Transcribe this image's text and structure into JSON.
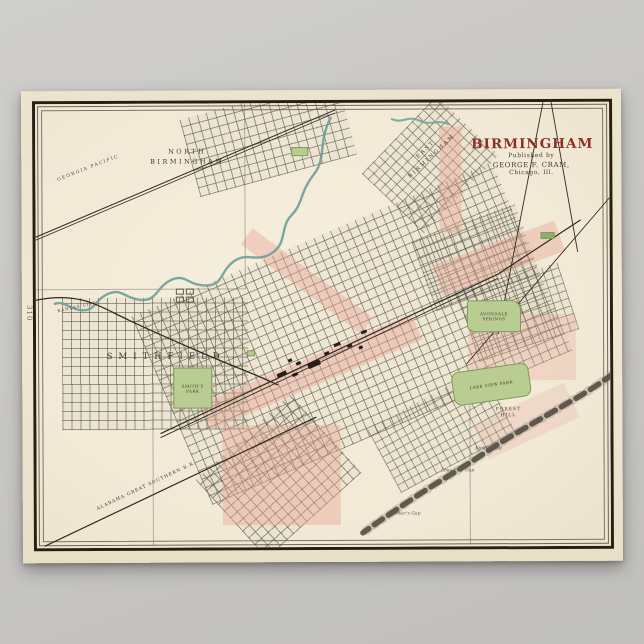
{
  "scene": {
    "background_color": "#c8c7c5"
  },
  "poster": {
    "paper_color": "#efe7d3",
    "page_number": "310",
    "title_block": {
      "title": "BIRMINGHAM",
      "publisher_line1": "Published by",
      "publisher_line2": "GEORGE F. CRAM,",
      "publisher_line3": "Chicago, Ill.",
      "title_color": "#8f2f28"
    },
    "labels": {
      "north_birmingham_line1": "NORTH",
      "north_birmingham_line2": "BIRMINGHAM",
      "east_birmingham_line1": "EAST",
      "east_birmingham_line2": "BIRMINGHAM",
      "smithfield": "SMITHFIELD",
      "smiths_park_line1": "SMITH'S",
      "smiths_park_line2": "PARK",
      "avondale_springs_line1": "AVONDALE",
      "avondale_springs_line2": "SPRINGS",
      "lakeview_park": "LAKE VIEW PARK",
      "forest_hill_line1": "FOREST",
      "forest_hill_line2": "HILL",
      "railroad_georgia_pacific": "GEORGIA PACIFIC",
      "railroad_kansas_city": "KANSAS CITY",
      "railroad_alabama_great_southern": "ALABAMA GREAT SOUTHERN R.R.",
      "gap1": "Kimble Gap",
      "gap2": "Lone Pine Gap",
      "gap3": "Parker's Gap"
    },
    "map_colors": {
      "city_limit_pink": "#e9a496",
      "park_green": "#b9cd92",
      "creek_teal": "#6f9f98",
      "ridge_gray": "#4b453c",
      "ink": "#3c362c"
    }
  }
}
